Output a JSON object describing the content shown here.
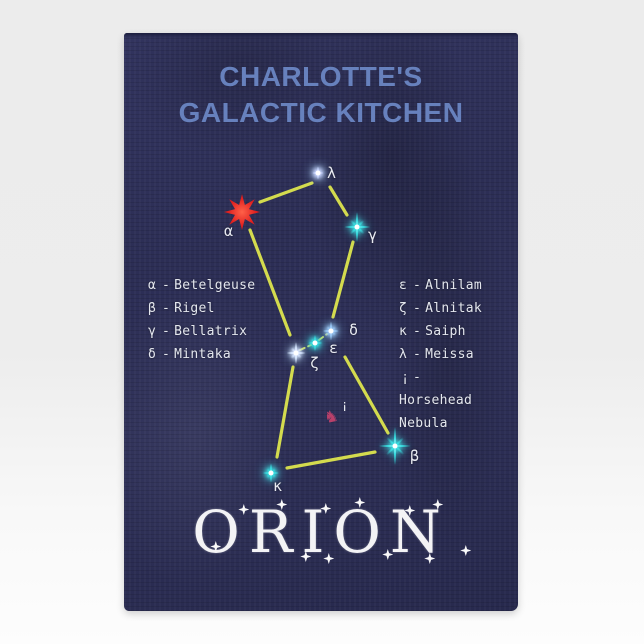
{
  "colors": {
    "background": "#ededed",
    "fabric": "#2c2e55",
    "title_blue": "#6781bd",
    "line_yellow": "#dde54e",
    "star_red": "#e01f1f",
    "star_cyan": "#35dede",
    "star_white": "#ffffff",
    "nebula_red": "#b8406a",
    "legend_text": "#e4e7ee"
  },
  "header": {
    "line1": "CHARLOTTE'S",
    "line2": "GALACTIC KITCHEN"
  },
  "constellation": {
    "title": "ORION",
    "stars": [
      {
        "id": "alpha",
        "name": "Betelgeuse",
        "greek": "α",
        "type": "burst",
        "x": 118,
        "y": 179,
        "size": 36,
        "color": "#e01f1f",
        "label_x": 100,
        "label_y": 189
      },
      {
        "id": "lambda",
        "name": "Meissa",
        "greek": "λ",
        "type": "sparkle",
        "x": 194,
        "y": 140,
        "size": 13,
        "color": "#cfd6ff",
        "label_x": 203,
        "label_y": 131
      },
      {
        "id": "gamma",
        "name": "Bellatrix",
        "greek": "γ",
        "type": "sparkle",
        "x": 233,
        "y": 194,
        "size": 30,
        "color": "#35dede",
        "label_x": 244,
        "label_y": 193
      },
      {
        "id": "delta",
        "name": "Mintaka",
        "greek": "δ",
        "type": "sparkle",
        "x": 207,
        "y": 298,
        "size": 19,
        "color": "#9fc8f5",
        "label_x": 225,
        "label_y": 288
      },
      {
        "id": "epsilon",
        "name": "Alnilam",
        "greek": "ε",
        "type": "sparkle",
        "x": 191,
        "y": 310,
        "size": 16,
        "color": "#35dede",
        "label_x": 205,
        "label_y": 306
      },
      {
        "id": "zeta",
        "name": "Alnitak",
        "greek": "ζ",
        "type": "sparkle",
        "x": 172,
        "y": 320,
        "size": 22,
        "color": "#dfe6ff",
        "label_x": 186,
        "label_y": 321
      },
      {
        "id": "kappa",
        "name": "Saiph",
        "greek": "κ",
        "type": "sparkle",
        "x": 147,
        "y": 440,
        "size": 19,
        "color": "#35dede",
        "label_x": 149,
        "label_y": 444
      },
      {
        "id": "beta",
        "name": "Rigel",
        "greek": "β",
        "type": "sparkle",
        "x": 271,
        "y": 413,
        "size": 38,
        "color": "#35dede",
        "label_x": 286,
        "label_y": 414
      }
    ],
    "lines": [
      {
        "x1": 136,
        "y1": 169,
        "x2": 188,
        "y2": 150
      },
      {
        "x1": 206,
        "y1": 154,
        "x2": 223,
        "y2": 182
      },
      {
        "x1": 126,
        "y1": 197,
        "x2": 166,
        "y2": 302
      },
      {
        "x1": 229,
        "y1": 209,
        "x2": 209,
        "y2": 284
      },
      {
        "x1": 169,
        "y1": 334,
        "x2": 153,
        "y2": 424
      },
      {
        "x1": 221,
        "y1": 324,
        "x2": 264,
        "y2": 400
      },
      {
        "x1": 163,
        "y1": 435,
        "x2": 251,
        "y2": 419
      }
    ],
    "belt_lines": [
      {
        "x1": 176,
        "y1": 317,
        "x2": 187,
        "y2": 312
      },
      {
        "x1": 195,
        "y1": 307,
        "x2": 203,
        "y2": 301
      }
    ],
    "nebula": {
      "glyph": "♞",
      "pin": "!",
      "glyph_x": 200,
      "glyph_y": 374,
      "pin_x": 217,
      "pin_y": 366
    }
  },
  "legend_left": {
    "separator": "-",
    "items": [
      {
        "symbol": "α",
        "name": "Betelgeuse"
      },
      {
        "symbol": "β",
        "name": "Rigel"
      },
      {
        "symbol": "γ",
        "name": "Bellatrix"
      },
      {
        "symbol": "δ",
        "name": "Mintaka"
      }
    ]
  },
  "legend_right": {
    "separator": "-",
    "items": [
      {
        "symbol": "ε",
        "name": "Alnilam"
      },
      {
        "symbol": "ζ",
        "name": "Alnitak"
      },
      {
        "symbol": "κ",
        "name": "Saiph"
      },
      {
        "symbol": "λ",
        "name": "Meissa"
      },
      {
        "symbol": "!",
        "name": "Horsehead Nebula",
        "flip_symbol": true
      }
    ]
  }
}
